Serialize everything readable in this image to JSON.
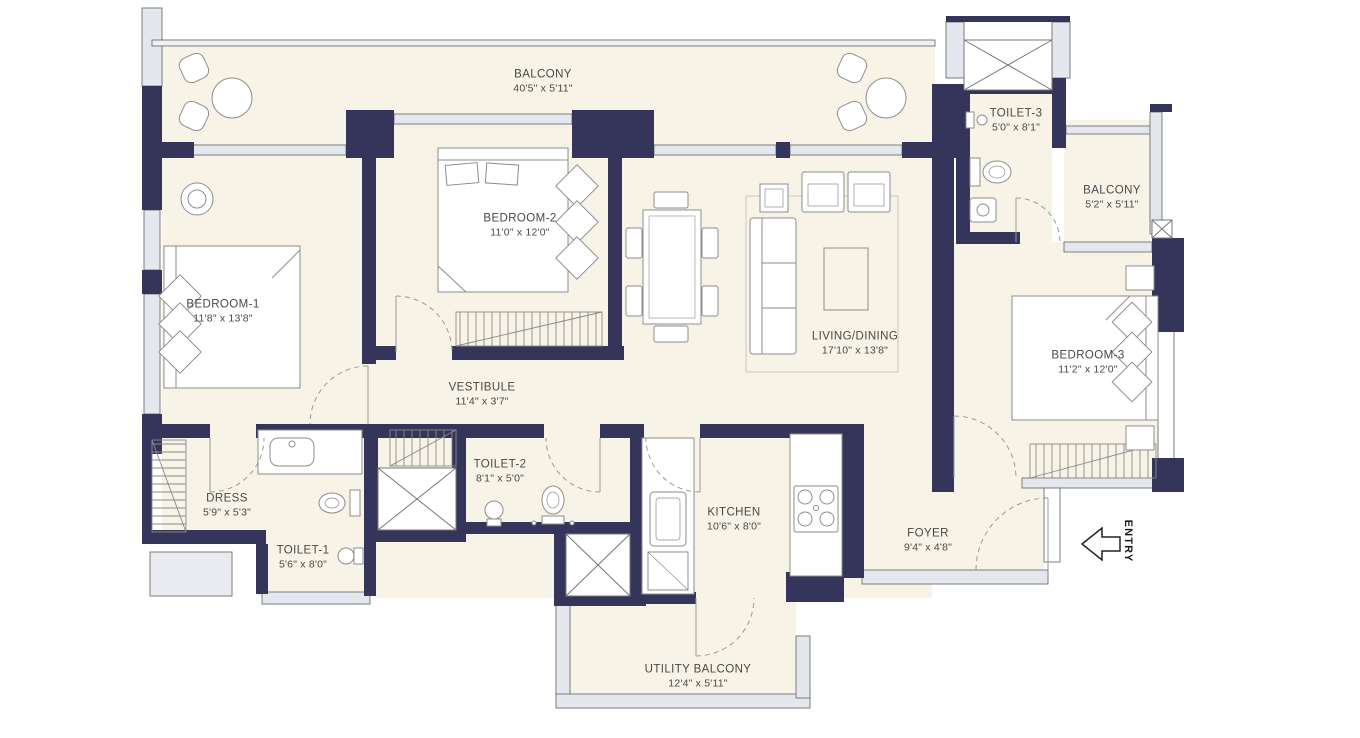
{
  "colors": {
    "wall": "#35355c",
    "floor": "#f7f3e6",
    "window_fill": "#e4e7ee",
    "outline_gray": "#8d8d8d",
    "label_text": "#484848"
  },
  "entry": {
    "label": "ENTRY"
  },
  "rooms": {
    "balcony_top": {
      "name": "BALCONY",
      "dims": "40'5\" x 5'11\""
    },
    "toilet3": {
      "name": "TOILET-3",
      "dims": "5'0\" x 8'1\""
    },
    "balcony_right": {
      "name": "BALCONY",
      "dims": "5'2\" x 5'11\""
    },
    "bedroom2": {
      "name": "BEDROOM-2",
      "dims": "11'0\" x 12'0\""
    },
    "bedroom1": {
      "name": "BEDROOM-1",
      "dims": "11'8\" x 13'8\""
    },
    "living": {
      "name": "LIVING/DINING",
      "dims": "17'10\" x 13'8\""
    },
    "bedroom3": {
      "name": "BEDROOM-3",
      "dims": "11'2\" x 12'0\""
    },
    "vestibule": {
      "name": "VESTIBULE",
      "dims": "11'4\" x 3'7\""
    },
    "dress": {
      "name": "DRESS",
      "dims": "5'9\" x 5'3\""
    },
    "toilet2": {
      "name": "TOILET-2",
      "dims": "8'1\" x 5'0\""
    },
    "toilet1": {
      "name": "TOILET-1",
      "dims": "5'6\" x 8'0\""
    },
    "kitchen": {
      "name": "KITCHEN",
      "dims": "10'6\" x 8'0\""
    },
    "foyer": {
      "name": "FOYER",
      "dims": "9'4\" x 4'8\""
    },
    "utility": {
      "name": "UTILITY BALCONY",
      "dims": "12'4\" x 5'11\""
    }
  }
}
